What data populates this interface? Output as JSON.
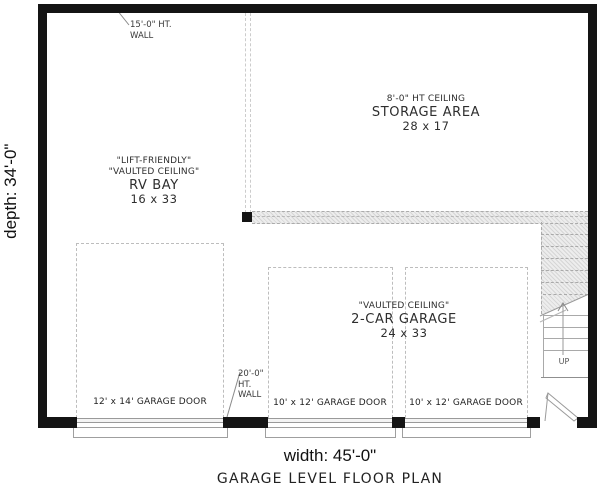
{
  "plan": {
    "title": "GARAGE LEVEL FLOOR PLAN",
    "width_label": "width: 45'-0\"",
    "depth_label": "depth: 34'-0\"",
    "rooms": {
      "rv_bay": {
        "note1": "\"LIFT-FRIENDLY\"",
        "note2": "\"VAULTED CEILING\"",
        "name": "RV BAY",
        "dims": "16 x 33"
      },
      "storage": {
        "note": "8'-0\" HT CEILING",
        "name": "STORAGE AREA",
        "dims": "28 x 17"
      },
      "garage": {
        "note": "\"VAULTED CEILING\"",
        "name": "2-CAR GARAGE",
        "dims": "24 x 33"
      }
    },
    "doors": {
      "door1": "12' x 14' GARAGE DOOR",
      "door2": "10' x 12' GARAGE DOOR",
      "door3": "10' x 12' GARAGE DOOR"
    },
    "annotations": {
      "wall15": {
        "line1": "15'-0\" HT.",
        "line2": "WALL"
      },
      "wall20": {
        "line1": "20'-0\"",
        "line2": "HT.",
        "line3": "WALL"
      },
      "up": "UP"
    },
    "colors": {
      "wall": "#141414",
      "dashed_line": "#bdbdbd",
      "hatch_bg": "#ededed",
      "hatch_line": "#d6d6d6",
      "thin_line": "#9a9a9a",
      "text": "#2b2b2b"
    }
  }
}
